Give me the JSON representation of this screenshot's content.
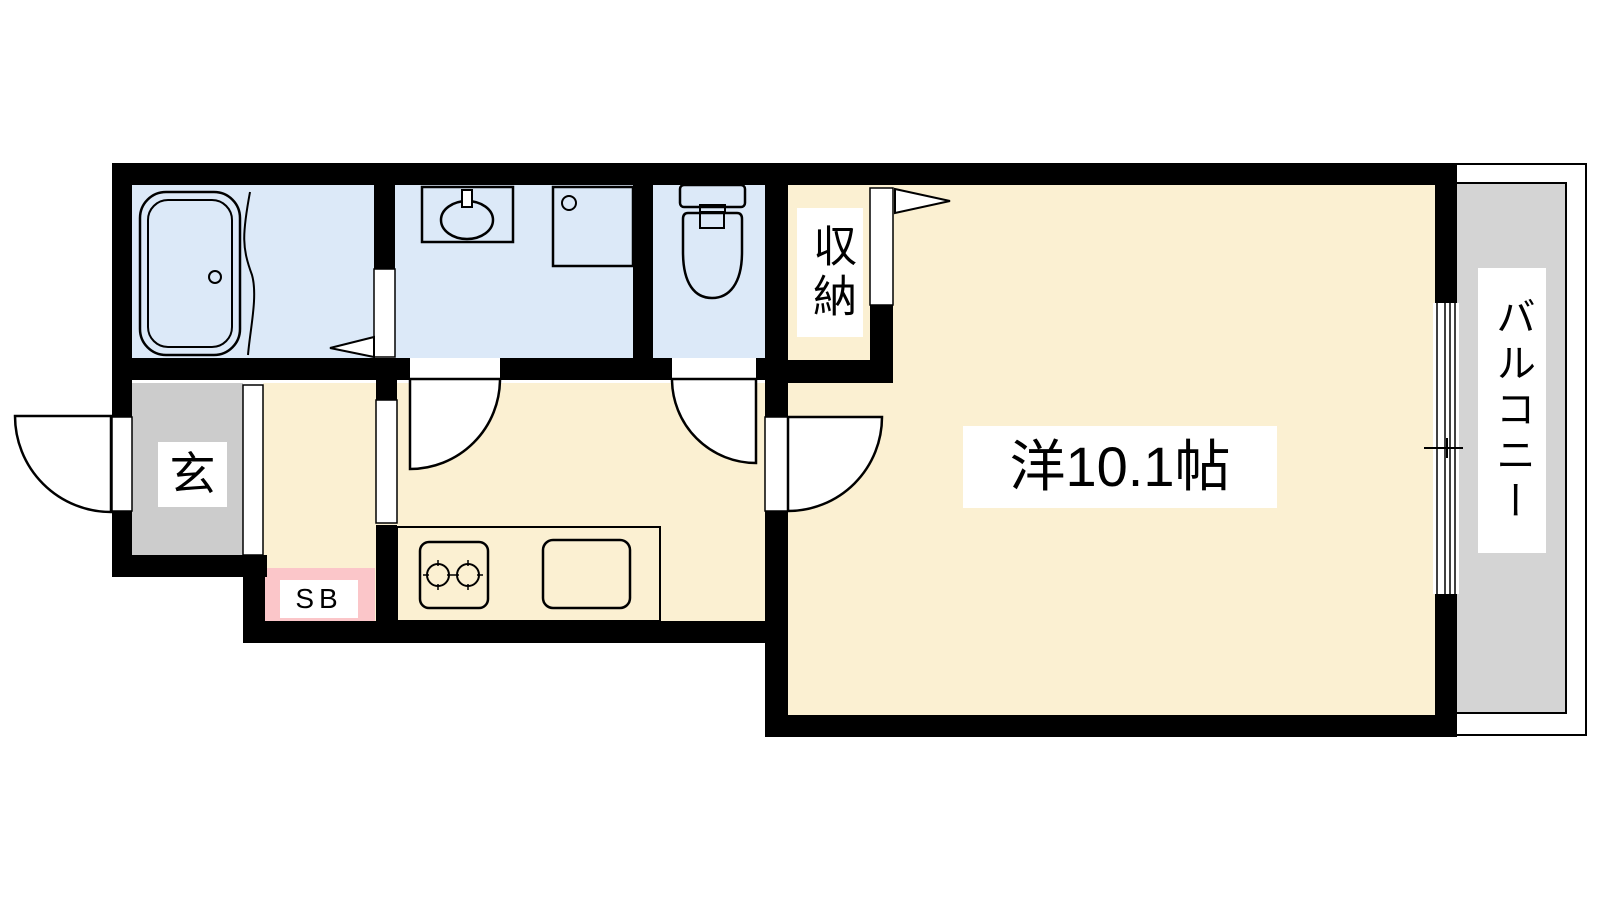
{
  "labels": {
    "main_room": "洋10.1帖",
    "balcony": "バルコニー",
    "closet": "収納",
    "entrance": "玄",
    "shoe_box": "SB"
  },
  "colors": {
    "wall": "#000000",
    "wet": "#DCE9F8",
    "floor": "#FBF0D2",
    "pink": "#FBC6C9",
    "gray": "#CCCCCC",
    "balgray": "#D4D4D4",
    "lavender": "#E7DFF2",
    "labelbg": "#FFFFFF",
    "text": "#000000"
  }
}
